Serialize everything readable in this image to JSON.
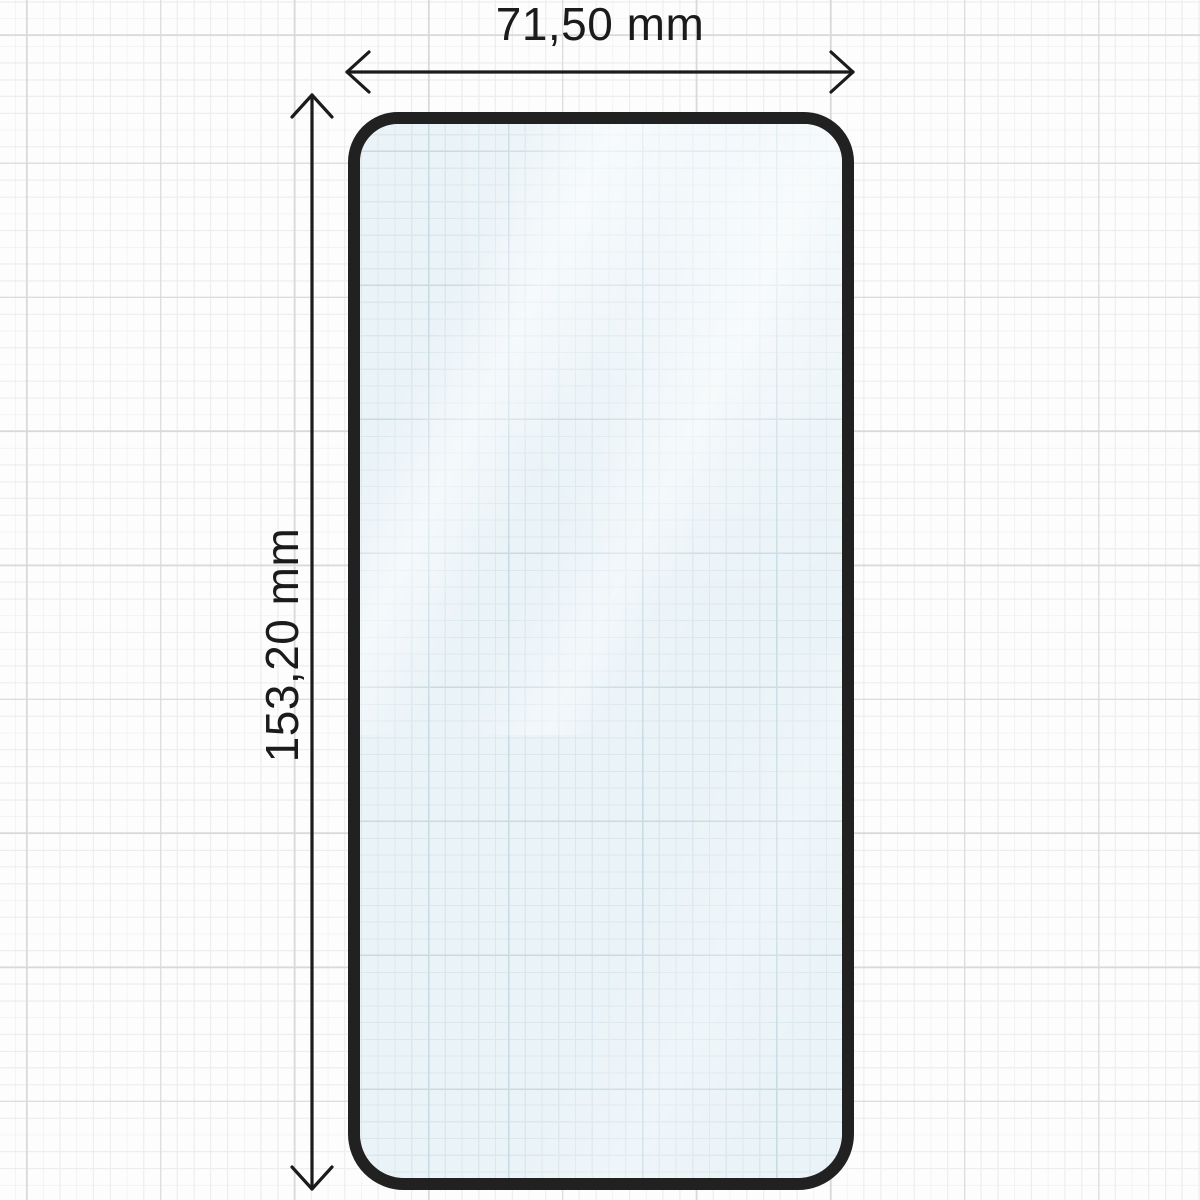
{
  "diagram": {
    "type": "screen-protector-dimension-diagram",
    "dimensions": {
      "width_label": "71,50 mm",
      "height_label": "153,20 mm"
    },
    "icons": {
      "width_arrow": "double-headed-horizontal-arrow-icon",
      "height_arrow": "double-headed-vertical-arrow-icon"
    },
    "colors": {
      "annotation_ink": "#1b1b1b",
      "glass_border": "#212121",
      "glass_fill": "#eaf3f7",
      "paper_background": "#fdfdfd",
      "grid_minor": "#ededed",
      "grid_major": "#d9d9d9",
      "glass_grid_minor": "#dae8ee",
      "glass_grid_major": "#c8dbe3"
    }
  }
}
